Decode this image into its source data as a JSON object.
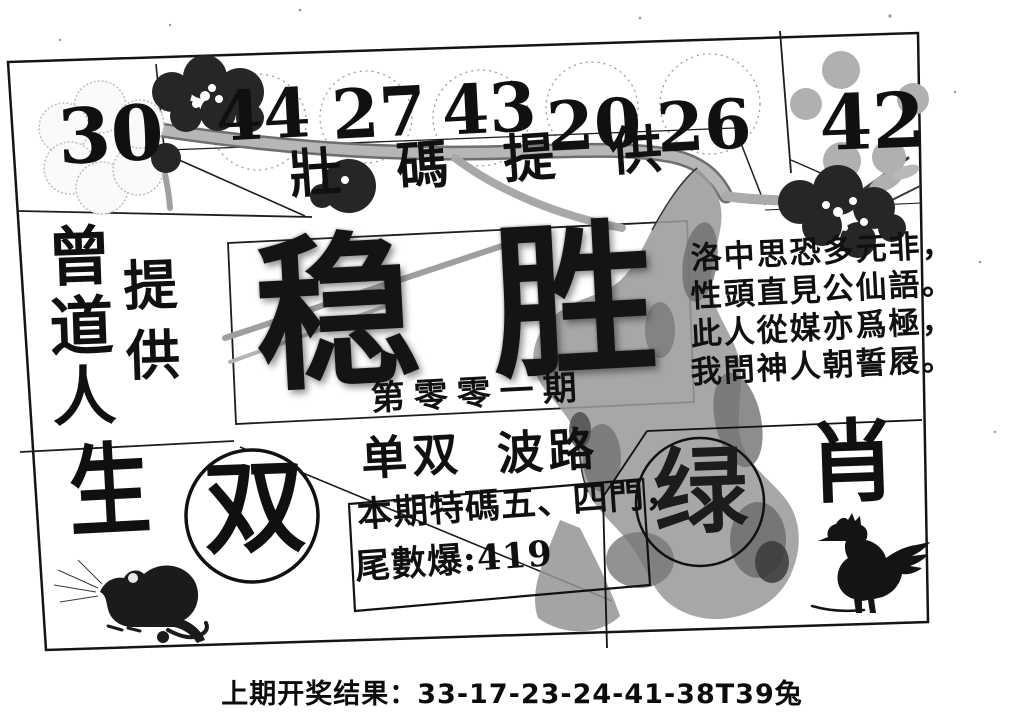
{
  "sheet": {
    "numbers": {
      "left": "30",
      "boxed": [
        "44",
        "27",
        "43",
        "20",
        "26"
      ],
      "right": "42"
    },
    "top_band": {
      "text": "壯碼提供"
    },
    "brand": {
      "name": "曾道人",
      "suffix": "提供",
      "big_char": "生"
    },
    "title": {
      "main": "稳胜",
      "issue": "第零零一期"
    },
    "poem": {
      "lines": [
        "洛中思恐多元非，",
        "性頭直見公仙語。",
        "此人從媒亦爲極，",
        "我問神人朝誓屐。"
      ]
    },
    "picks": {
      "odd_even_label": "单双",
      "wave_label": "波路",
      "odd_even_pick": "双",
      "color_pick": "绿",
      "zodiac_label": "肖"
    },
    "special": {
      "line1": "本期特碼五、四門，",
      "line2": "尾數爆:419"
    },
    "icons": {
      "rat": "rat-ink-painting",
      "rooster": "rooster-ink-painting",
      "plum_light": "plum-blossom-outline",
      "plum_dark": "plum-blossom-dark",
      "branch": "plum-branch",
      "trunk": "tree-trunk"
    }
  },
  "footer": {
    "label": "上期开奖结果：",
    "value": "33-17-23-24-41-38T39兔"
  },
  "colors": {
    "ink": "#111111",
    "paper": "#ffffff",
    "branch_gray": "#ababab",
    "trunk_gray": "#9b9b9b"
  }
}
